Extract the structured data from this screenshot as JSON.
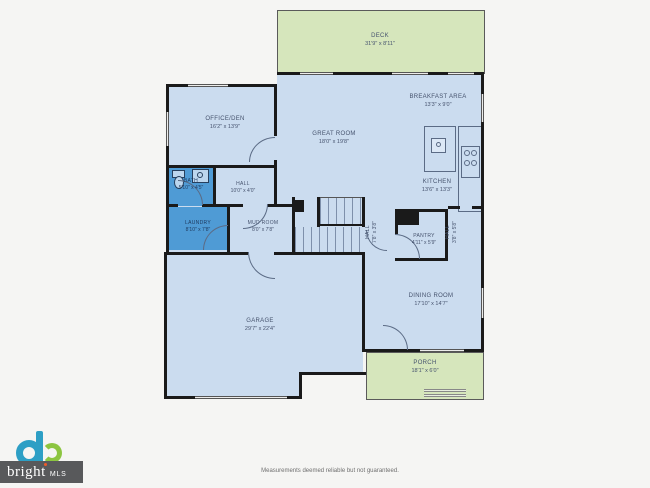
{
  "rooms": {
    "deck": {
      "name": "DECK",
      "dims": "31'9\" x 8'11\""
    },
    "breakfast": {
      "name": "BREAKFAST AREA",
      "dims": "13'3\" x 9'0\""
    },
    "great": {
      "name": "GREAT ROOM",
      "dims": "18'0\" x 19'8\""
    },
    "office": {
      "name": "OFFICE/DEN",
      "dims": "16'2\" x 13'9\""
    },
    "kitchen": {
      "name": "KITCHEN",
      "dims": "13'6\" x 13'3\""
    },
    "bath": {
      "name": "BATH",
      "dims": "5'10\" x 4'5\""
    },
    "hall_main": {
      "name": "HALL",
      "dims": "10'0\" x 4'0\""
    },
    "laundry": {
      "name": "LAUNDRY",
      "dims": "8'10\" x 7'8\""
    },
    "mudroom": {
      "name": "MUD ROOM",
      "dims": "8'0\" x 7'8\""
    },
    "pantry": {
      "name": "PANTRY",
      "dims": "4'11\" x 5'9\""
    },
    "hall_stairs": {
      "name": "HALL",
      "dims": "7'8\" x 3'8\""
    },
    "hall_right": {
      "name": "HALL",
      "dims": "3'8\" x 5'8\""
    },
    "dining": {
      "name": "DINING ROOM",
      "dims": "17'10\" x 14'7\""
    },
    "garage": {
      "name": "GARAGE",
      "dims": "29'7\" x 22'4\""
    },
    "porch": {
      "name": "PORCH",
      "dims": "18'1\" x 6'0\""
    }
  },
  "logo": {
    "brand": "bright",
    "suffix": "MLS"
  },
  "footer": {
    "disclaimer": "Measurements deemed reliable but not guaranteed."
  },
  "colors": {
    "background": "#f5f5f3",
    "room_fill": "#cbdcef",
    "wet_room_fill": "#4f9bd5",
    "outdoor_fill": "#d6e6bc",
    "wall": "#1a1a1a",
    "label_text": "#46536e",
    "logo_teal": "#2d9fc5",
    "logo_green": "#8cc540",
    "logo_band": "#58595b",
    "logo_accent": "#f05a28"
  },
  "icons": {
    "logo-mark-icon": "teal d-ring with green swirl (css circles)",
    "toilet-icon": "oval bowl + tank rectangle",
    "sink-icon": "rectangle with round basin dot",
    "cooktop-icon": "box with 4 burner dots",
    "stairs-icon": "parallel tread lines"
  }
}
